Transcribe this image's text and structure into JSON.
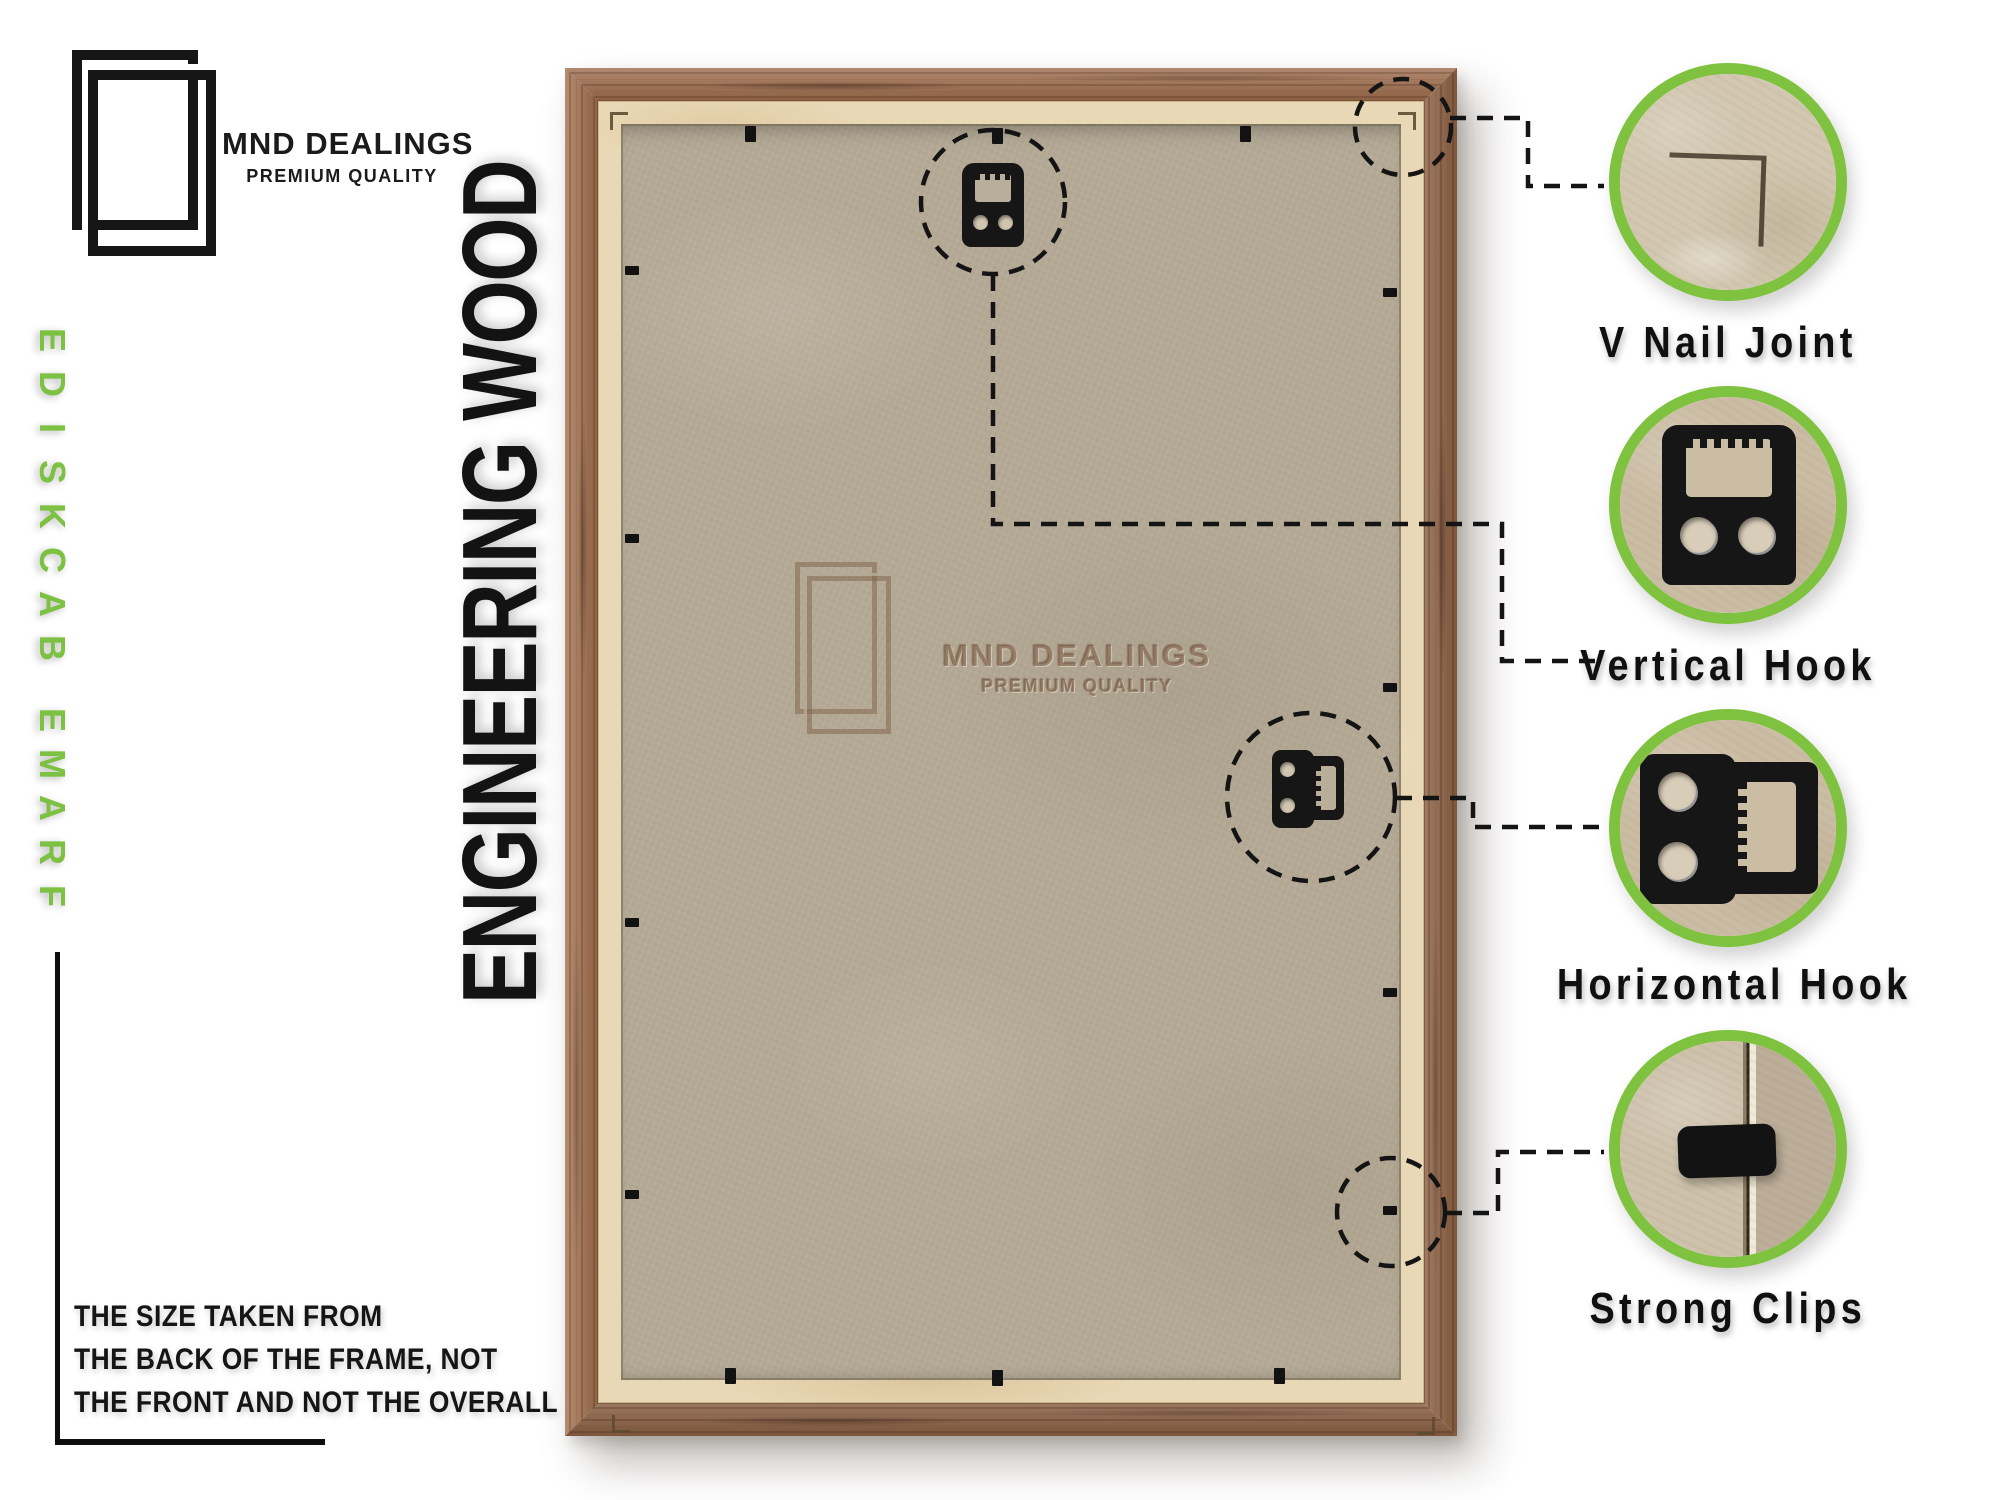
{
  "brand": {
    "name": "MND DEALINGS",
    "tagline": "PREMIUM QUALITY"
  },
  "side_label": "FRAME BACKSIDE",
  "material_label": "ENGINEERING WOOD",
  "watermark": {
    "name": "MND DEALINGS",
    "tagline": "PREMIUM QUALITY"
  },
  "note": {
    "line1": "THE SIZE TAKEN FROM",
    "line2": "THE BACK OF THE FRAME, NOT",
    "line3": "THE FRONT AND NOT THE OVERALL SIZE."
  },
  "callouts": {
    "items": [
      {
        "label": "V Nail Joint",
        "icon": "v-nail-joint-photo"
      },
      {
        "label": "Vertical Hook",
        "icon": "vertical-hook-photo"
      },
      {
        "label": "Horizontal Hook",
        "icon": "horizontal-hook-photo"
      },
      {
        "label": "Strong Clips",
        "icon": "strong-clip-photo"
      }
    ]
  },
  "colors": {
    "accent_green": "#7ec23f",
    "wood_brown": "#9d6b4a",
    "liner_cream": "#e9d8b5",
    "backboard": "#b3a995",
    "line_black": "#141414"
  }
}
